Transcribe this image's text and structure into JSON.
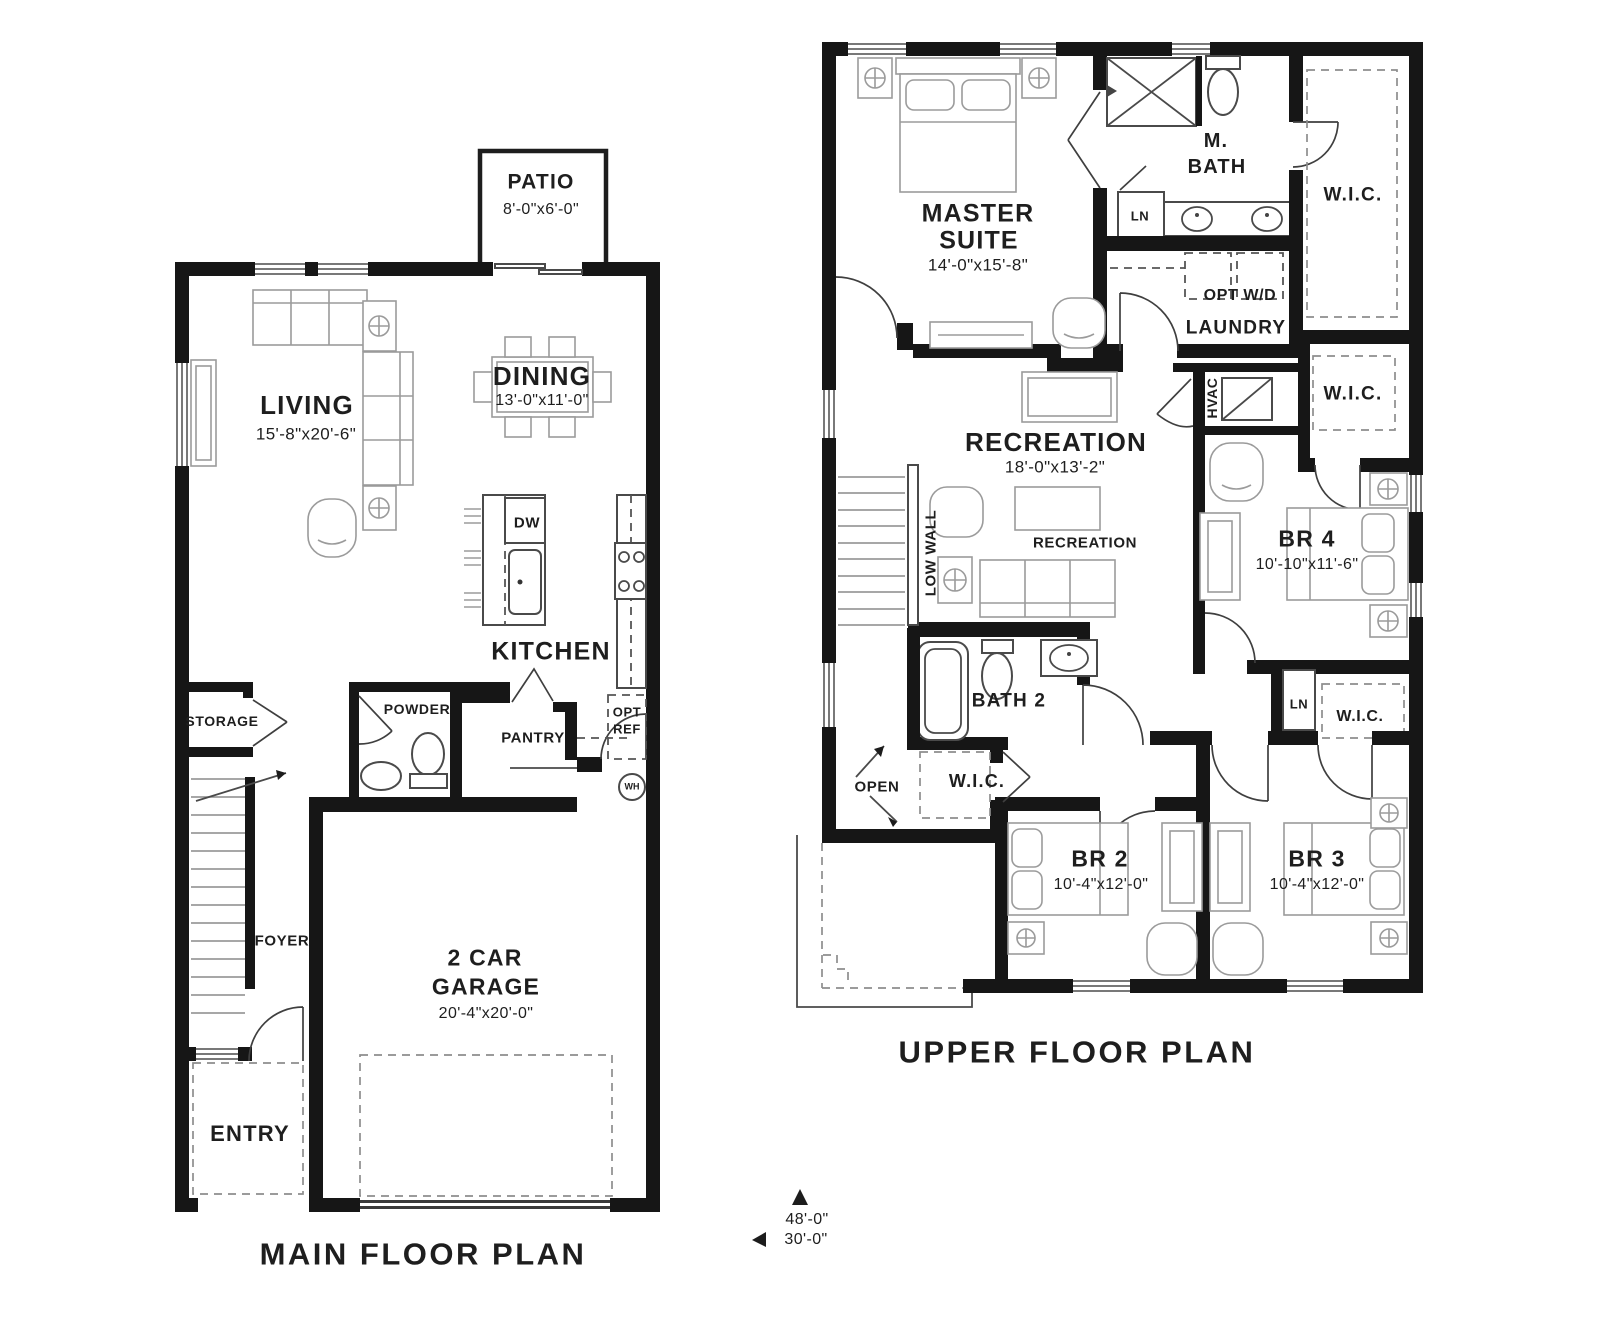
{
  "colors": {
    "wall": "#161616",
    "furniture_line": "#9b9b9b",
    "text": "#1e1e1e",
    "dash": "#8d8d8d"
  },
  "main_plan": {
    "title": "MAIN FLOOR PLAN",
    "patio": {
      "label": "PATIO",
      "dims": "8'-0\"x6'-0\""
    },
    "living": {
      "label": "LIVING",
      "dims": "15'-8\"x20'-6\""
    },
    "dining": {
      "label": "DINING",
      "dims": "13'-0\"x11'-0\""
    },
    "kitchen": {
      "label": "KITCHEN"
    },
    "dishwasher": {
      "label": "DW"
    },
    "opt_ref": {
      "line1": "OPT",
      "line2": "REF"
    },
    "water_heater": {
      "label": "WH"
    },
    "storage": {
      "label": "STORAGE"
    },
    "powder": {
      "label": "POWDER"
    },
    "pantry": {
      "label": "PANTRY"
    },
    "foyer": {
      "label": "FOYER"
    },
    "garage": {
      "line1": "2 CAR",
      "line2": "GARAGE",
      "dims": "20'-4\"x20'-0\""
    },
    "entry": {
      "label": "ENTRY"
    }
  },
  "upper_plan": {
    "title": "UPPER FLOOR PLAN",
    "master": {
      "line1": "MASTER",
      "line2": "SUITE",
      "dims": "14'-0\"x15'-8\""
    },
    "master_bath": {
      "line1": "M.",
      "line2": "BATH"
    },
    "wic_master": {
      "label": "W.I.C."
    },
    "linen1": {
      "label": "LN"
    },
    "opt_wd": {
      "label": "OPT W/D"
    },
    "laundry": {
      "label": "LAUNDRY"
    },
    "hvac": {
      "label": "HVAC"
    },
    "wic_2": {
      "label": "W.I.C."
    },
    "recreation": {
      "label": "RECREATION",
      "dims": "18'-0\"x13'-2\"",
      "sublabel": "RECREATION"
    },
    "low_wall": {
      "label": "LOW WALL"
    },
    "br4": {
      "label": "BR 4",
      "dims": "10'-10\"x11'-6\""
    },
    "bath2": {
      "label": "BATH 2"
    },
    "linen2": {
      "label": "LN"
    },
    "wic_3": {
      "label": "W.I.C."
    },
    "wic_4": {
      "label": "W.I.C."
    },
    "open": {
      "label": "OPEN"
    },
    "br2": {
      "label": "BR 2",
      "dims": "10'-4\"x12'-0\""
    },
    "br3": {
      "label": "BR 3",
      "dims": "10'-4\"x12'-0\""
    }
  },
  "footer_dims": {
    "depth": "48'-0\"",
    "width": "30'-0\""
  }
}
